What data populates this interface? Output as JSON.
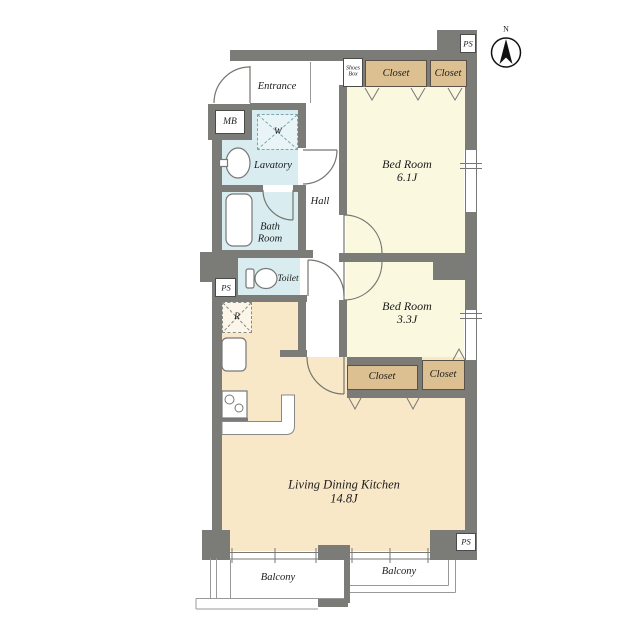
{
  "plan": {
    "type": "floor-plan",
    "rooms": {
      "entrance": "Entrance",
      "lavatory": "Lavatory",
      "bath_line1": "Bath",
      "bath_line2": "Room",
      "toilet": "Toilet",
      "hall": "Hall",
      "bedroom1_name": "Bed Room",
      "bedroom1_size": "6.1J",
      "bedroom2_name": "Bed Room",
      "bedroom2_size": "3.3J",
      "ldk_name": "Living Dining Kitchen",
      "ldk_size": "14.8J",
      "balcony_left": "Balcony",
      "balcony_right": "Balcony"
    },
    "fixtures": {
      "meter_box": "MB",
      "washer": "W",
      "fridge": "R",
      "shoes_box_line1": "Shoes",
      "shoes_box_line2": "Box"
    },
    "closets": [
      "Closet",
      "Closet",
      "Closet",
      "Closet"
    ],
    "ps_labels": {
      "top": "PS",
      "middle": "PS",
      "bottom": "PS"
    },
    "compass_n": "N",
    "colors": {
      "wall": "#7b7b78",
      "room_cream": "#fbf8e0",
      "closet_tan": "#dcc092",
      "ldk_peach": "#f9e8c8",
      "wet_area_blue": "#d9ecef",
      "thin_line": "#999999"
    }
  }
}
